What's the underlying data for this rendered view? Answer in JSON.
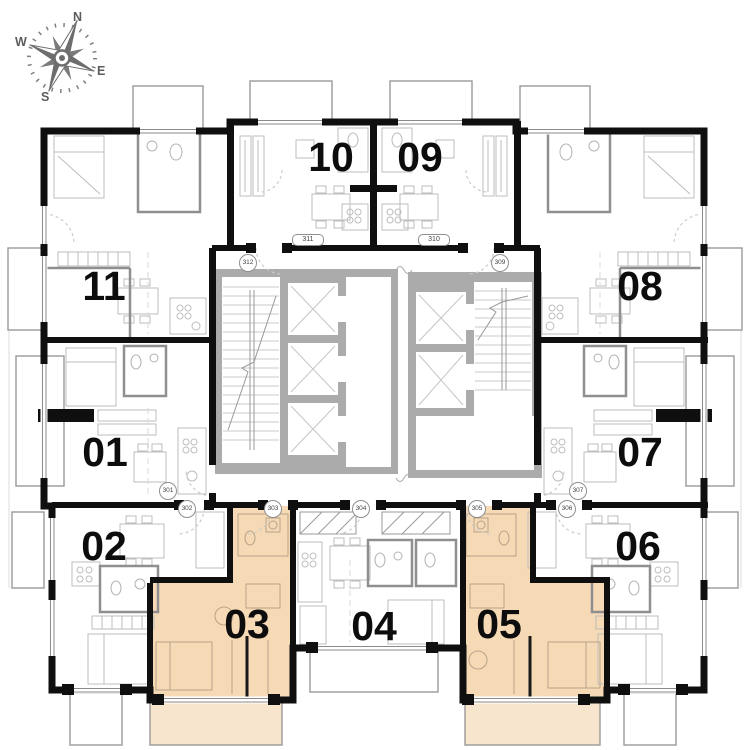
{
  "compass": {
    "north": "N",
    "east": "E",
    "south": "S",
    "west": "W"
  },
  "units": [
    {
      "number": "01",
      "highlighted": false
    },
    {
      "number": "02",
      "highlighted": false
    },
    {
      "number": "03",
      "highlighted": true
    },
    {
      "number": "04",
      "highlighted": false
    },
    {
      "number": "05",
      "highlighted": true
    },
    {
      "number": "06",
      "highlighted": false
    },
    {
      "number": "07",
      "highlighted": false
    },
    {
      "number": "08",
      "highlighted": false
    },
    {
      "number": "09",
      "highlighted": false
    },
    {
      "number": "10",
      "highlighted": false
    },
    {
      "number": "11",
      "highlighted": false
    }
  ],
  "door_tags": {
    "t301": "301",
    "t302": "302",
    "t303": "303",
    "t304": "304",
    "t305": "305",
    "t306": "306",
    "t307": "307",
    "t309": "309",
    "t310": "310",
    "t311": "311",
    "t312": "312"
  },
  "colors": {
    "unit_highlight": "#f6d9b5",
    "balcony_highlight": "#f8e5ce",
    "wall_black": "#0f0f0f",
    "core_gray": "#ababab"
  }
}
